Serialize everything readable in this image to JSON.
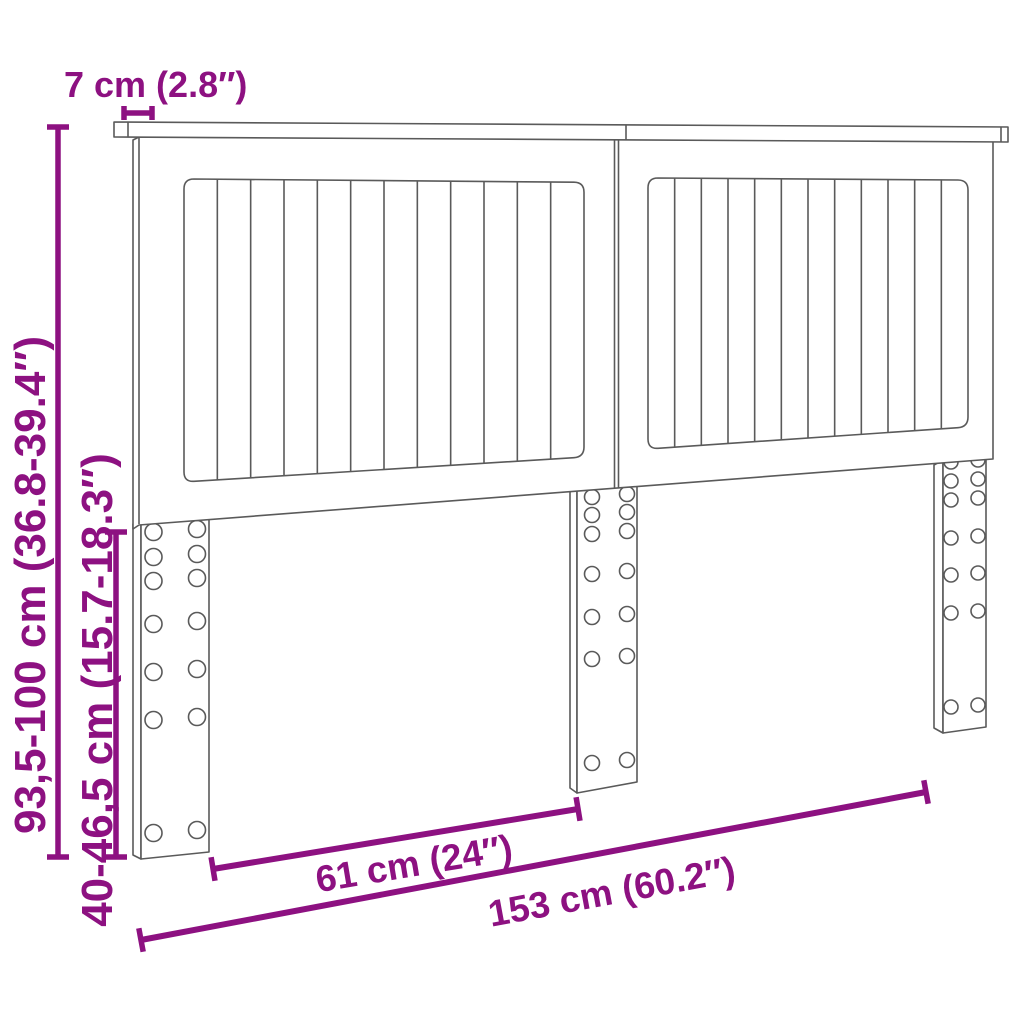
{
  "title": "Headboard dimension diagram",
  "figure": "bed headboard with two slatted panels and three pre-drilled mounting legs",
  "colors": {
    "dimension": "#8d1181",
    "outline": "#5a5a5a",
    "background": "#ffffff"
  },
  "dimensions": {
    "top_rail_depth": "7 cm (2.8″)",
    "total_height": "93,5-100 cm (36.8-39.4″)",
    "leg_height": "40-46,5 cm (15.7-18.3″)",
    "between_legs_width": "61 cm (24″)",
    "total_width": "153 cm (60.2″)"
  }
}
